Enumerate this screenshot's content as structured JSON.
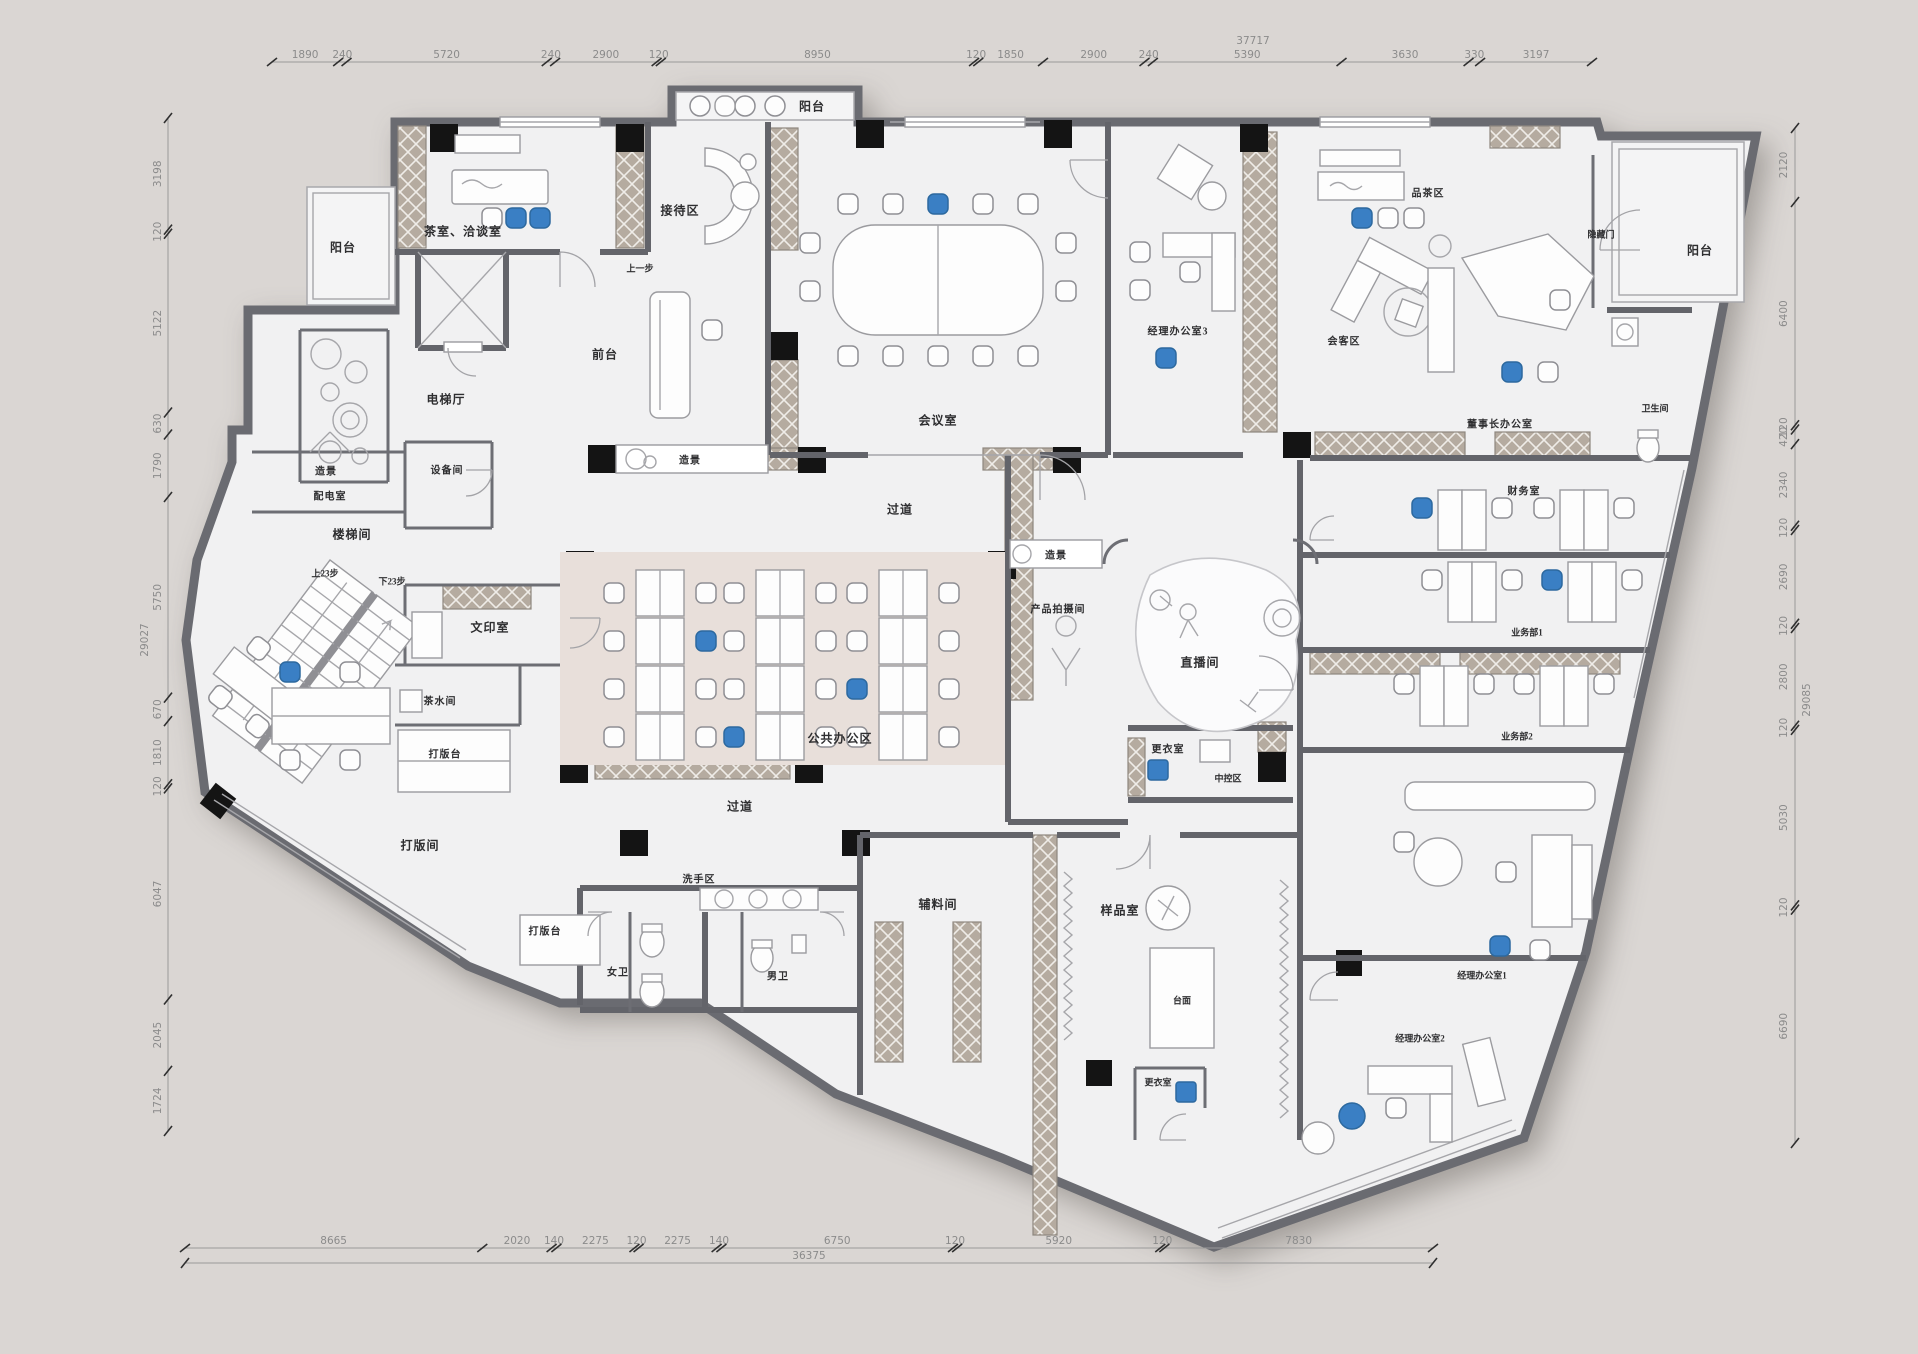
{
  "title": "办公空间平面布置图",
  "colors": {
    "background": "#dad6d3",
    "floor": "#f1f1f2",
    "open_office_floor": "#e8dfda",
    "wall": "#63646a",
    "hatch": "#b5aba0",
    "column": "#141414",
    "accent_blue": "#3a7fc4"
  },
  "labels": {
    "balcony_left": "阳台",
    "balcony_top": "阳台",
    "balcony_topright": "阳台",
    "tea_room": "茶室、洽谈室",
    "reception": "接待区",
    "step_note": "上一步",
    "front_desk": "前台",
    "elevator_hall": "电梯厅",
    "equipment_room": "设备间",
    "landscape_left": "造景",
    "landscape_center": "造景",
    "landscape_right": "造景",
    "power_room": "配电室",
    "stair_room": "楼梯间",
    "up_23": "上23步",
    "down_23": "下23步",
    "print_room": "文印室",
    "pantry": "茶水间",
    "pattern_table_1": "打版台",
    "pattern_table_2": "打版台",
    "pattern_room": "打版间",
    "meeting_room": "会议室",
    "corridor_1": "过道",
    "corridor_2": "过道",
    "open_office": "公共办公区",
    "wash_area": "洗手区",
    "womens_toilet": "女卫",
    "mens_toilet": "男卫",
    "aux_material_room": "辅料间",
    "sample_room": "样品室",
    "counter_top": "台面",
    "dressing_room_1": "更衣室",
    "dressing_room_2": "更衣室",
    "control_area": "中控区",
    "product_photo_room": "产品拍摄间",
    "live_room": "直播间",
    "manager_office_1": "经理办公室1",
    "manager_office_2": "经理办公室2",
    "manager_office_3": "经理办公室3",
    "tea_tasting_area": "品茶区",
    "guest_area": "会客区",
    "chairman_office": "董事长办公室",
    "hidden_door": "隐藏门",
    "toilet_topright": "卫生间",
    "finance_room": "财务室",
    "sales_dept_1": "业务部1",
    "sales_dept_2": "业务部2"
  },
  "dimensions": {
    "top": {
      "total": "37717",
      "segments": [
        "1890",
        "240",
        "5720",
        "240",
        "2900",
        "120",
        "8950",
        "120",
        "1850",
        "2900",
        "240",
        "5390",
        "3630",
        "330",
        "3197"
      ]
    },
    "bottom": {
      "total": "36375",
      "segments": [
        "8665",
        "2020",
        "140",
        "2275",
        "120",
        "2275",
        "140",
        "6750",
        "120",
        "5920",
        "120",
        "7830"
      ]
    },
    "left": {
      "total": "29027",
      "segments": [
        "3198",
        "120",
        "5122",
        "630",
        "1790",
        "5750",
        "670",
        "1810",
        "120",
        "6047",
        "2045",
        "1724"
      ]
    },
    "right": {
      "total": "29085",
      "segments": [
        "2120",
        "6400",
        "120",
        "420",
        "2340",
        "120",
        "2690",
        "120",
        "2800",
        "120",
        "5030",
        "120",
        "6690"
      ]
    }
  }
}
